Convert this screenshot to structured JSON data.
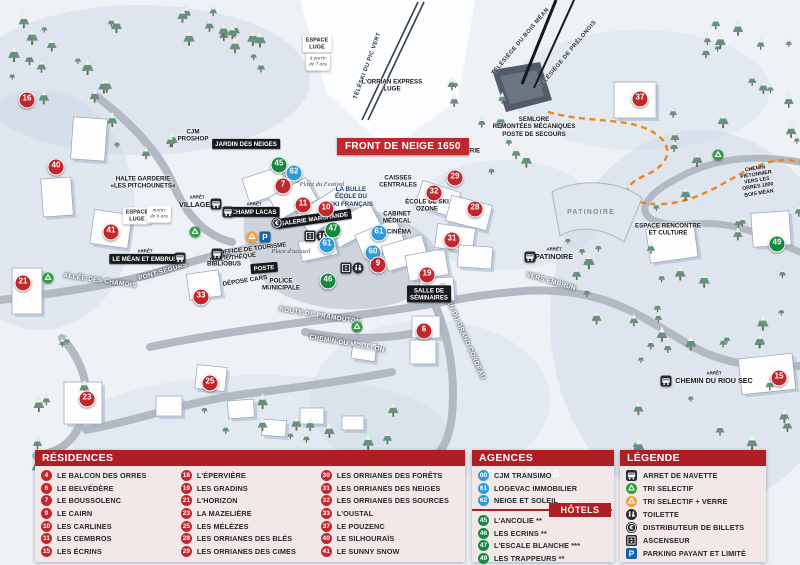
{
  "colors": {
    "residence": "#c1272d",
    "agency": "#2b9cd8",
    "hotel": "#14893f",
    "header": "#b01d23",
    "panel_bg": "#f4e7e7",
    "dash": "#f08519"
  },
  "map": {
    "front_badge": "FRONT DE NEIGE 1650",
    "arret_label": "ARRÊT",
    "markers": [
      {
        "n": "16",
        "type": "residence",
        "x": 27,
        "y": 100
      },
      {
        "n": "40",
        "type": "residence",
        "x": 56,
        "y": 167
      },
      {
        "n": "41",
        "type": "residence",
        "x": 111,
        "y": 232
      },
      {
        "n": "21",
        "type": "residence",
        "x": 23,
        "y": 283
      },
      {
        "n": "23",
        "type": "residence",
        "x": 87,
        "y": 399
      },
      {
        "n": "25",
        "type": "residence",
        "x": 210,
        "y": 383
      },
      {
        "n": "33",
        "type": "residence",
        "x": 201,
        "y": 297
      },
      {
        "n": "45",
        "type": "hotel",
        "x": 279,
        "y": 165
      },
      {
        "n": "62",
        "type": "agency",
        "x": 294,
        "y": 173
      },
      {
        "n": "7",
        "type": "residence",
        "x": 283,
        "y": 186
      },
      {
        "n": "11",
        "type": "residence",
        "x": 303,
        "y": 205
      },
      {
        "n": "10",
        "type": "residence",
        "x": 326,
        "y": 209
      },
      {
        "n": "47",
        "type": "hotel",
        "x": 333,
        "y": 230
      },
      {
        "n": "61",
        "type": "agency",
        "x": 327,
        "y": 245
      },
      {
        "n": "61",
        "type": "agency",
        "x": 379,
        "y": 233
      },
      {
        "n": "60",
        "type": "agency",
        "x": 373,
        "y": 253
      },
      {
        "n": "9",
        "type": "residence",
        "x": 378,
        "y": 265
      },
      {
        "n": "46",
        "type": "hotel",
        "x": 328,
        "y": 281
      },
      {
        "n": "19",
        "type": "residence",
        "x": 427,
        "y": 275
      },
      {
        "n": "6",
        "type": "residence",
        "x": 424,
        "y": 331
      },
      {
        "n": "32",
        "type": "residence",
        "x": 434,
        "y": 193
      },
      {
        "n": "29",
        "type": "residence",
        "x": 455,
        "y": 178
      },
      {
        "n": "28",
        "type": "residence",
        "x": 475,
        "y": 209
      },
      {
        "n": "31",
        "type": "residence",
        "x": 452,
        "y": 240
      },
      {
        "n": "37",
        "type": "residence",
        "x": 640,
        "y": 99
      },
      {
        "n": "49",
        "type": "hotel",
        "x": 777,
        "y": 244
      },
      {
        "n": "15",
        "type": "residence",
        "x": 779,
        "y": 378
      }
    ],
    "labels": [
      {
        "t": "ALLÉE DES CHAMOIS",
        "x": 100,
        "y": 281,
        "s": "road",
        "r": 8
      },
      {
        "t": "PONT SEGURS",
        "x": 163,
        "y": 272,
        "s": "road",
        "r": -16
      },
      {
        "t": "ROUTE DE PRAMOUTON",
        "x": 320,
        "y": 316,
        "s": "road",
        "r": 9
      },
      {
        "t": "CHEMIN DU MOUFLON",
        "x": 347,
        "y": 344,
        "s": "road",
        "r": 10
      },
      {
        "t": "CHEMIN DU GRAND CORDEAU",
        "x": 462,
        "y": 332,
        "s": "road",
        "r": 66
      },
      {
        "t": "VERS EMBRUN",
        "x": 551,
        "y": 282,
        "s": "road",
        "r": 16
      },
      {
        "t": "LAVERIE",
        "x": 467,
        "y": 151,
        "s": "dark",
        "r": 0
      },
      {
        "t": "CAISSES\nCENTRALES",
        "x": 398,
        "y": 182,
        "s": "dark",
        "r": 0
      },
      {
        "t": "ÉCOLE DE SKI\nOZONE",
        "x": 427,
        "y": 206,
        "s": "dark",
        "r": 0
      },
      {
        "t": "CABINET\nMÉDICAL",
        "x": 397,
        "y": 218,
        "s": "dark",
        "r": 0
      },
      {
        "t": "CINÉMA",
        "x": 399,
        "y": 232,
        "s": "dark",
        "r": 0
      },
      {
        "t": "LA BULLE\nÉCOLE DU\nSKI FRANÇAIS",
        "x": 351,
        "y": 197,
        "s": "blue",
        "r": 0
      },
      {
        "t": "HALTE GARDERIE\n«LES PITCHOUNETS»",
        "x": 143,
        "y": 183,
        "s": "dark",
        "r": 0
      },
      {
        "t": "OFFICE DE TOURISME",
        "x": 253,
        "y": 249,
        "s": "dark",
        "r": -7
      },
      {
        "t": "BIBLIOTHÈQUE",
        "x": 233,
        "y": 258,
        "s": "dark",
        "r": -7
      },
      {
        "t": "DÉPOSE CARS",
        "x": 245,
        "y": 281,
        "s": "dark",
        "r": -9
      },
      {
        "t": "POLICE\nMUNICIPALE",
        "x": 281,
        "y": 285,
        "s": "dark",
        "r": 0
      },
      {
        "t": "SEMLORE\nREMONTÉES MÉCANIQUES\nPOSTE DE SECOURS",
        "x": 534,
        "y": 127,
        "s": "dark",
        "r": 0
      },
      {
        "t": "PATINOIRE",
        "x": 591,
        "y": 213,
        "s": "gray",
        "r": 0
      },
      {
        "t": "ESPACE RENCONTRE\nET CULTURE",
        "x": 668,
        "y": 230,
        "s": "dark",
        "r": 0
      },
      {
        "t": "CJM\nPROSHOP",
        "x": 193,
        "y": 136,
        "s": "dark",
        "r": 0
      },
      {
        "t": "L'ORRIAN EXPRESS\nLUGE",
        "x": 392,
        "y": 86,
        "s": "dark",
        "r": 0
      },
      {
        "t": "TÉLÉSKI DU PIC VERT",
        "x": 368,
        "y": 66,
        "s": "lift",
        "r": -70
      },
      {
        "t": "TÉLÉSIÈGE DU BOIS MÉAN",
        "x": 521,
        "y": 42,
        "s": "lift",
        "r": -50
      },
      {
        "t": "TÉLÉSIÈGE DE PRÉLONGIS",
        "x": 568,
        "y": 55,
        "s": "lift",
        "r": -50
      },
      {
        "t": "CHEMIN PIÉTONNIER\nVERS LES ORRES 1800\nBOIS MÉAN",
        "x": 757,
        "y": 181,
        "s": "tiny",
        "r": -9
      },
      {
        "t": "VILLAGES",
        "x": 197,
        "y": 205,
        "s": "place",
        "r": 0,
        "a": true
      },
      {
        "t": "LE MÉAN ET EMBRUN",
        "x": 145,
        "y": 259,
        "s": "bar",
        "r": 0,
        "a": true
      },
      {
        "t": "PATINOIRE",
        "x": 554,
        "y": 257,
        "s": "place",
        "r": 0,
        "a": true
      },
      {
        "t": "CHEMIN DU RIOU SEC",
        "x": 714,
        "y": 381,
        "s": "place",
        "r": 0,
        "a": true
      },
      {
        "t": "BIBLIOBUS",
        "x": 224,
        "y": 264,
        "s": "dark",
        "r": 0,
        "a": true
      },
      {
        "t": "CHAMP LACAS",
        "x": 254,
        "y": 212,
        "s": "bar",
        "r": 0,
        "a": true
      },
      {
        "t": "GALERIE MARCHANDE",
        "x": 314,
        "y": 219,
        "s": "bar",
        "r": -8
      },
      {
        "t": "POSTE",
        "x": 264,
        "y": 268,
        "s": "bar",
        "r": -5
      },
      {
        "t": "SALLE DE\nSÉMINAIRES",
        "x": 429,
        "y": 294,
        "s": "bar",
        "r": 0
      },
      {
        "t": "JARDIN DES NEIGES",
        "x": 246,
        "y": 144,
        "s": "bar",
        "r": 0
      },
      {
        "t": "Place du Festival",
        "x": 322,
        "y": 185,
        "s": "italic",
        "r": 0
      },
      {
        "t": "Place d'accueil",
        "x": 291,
        "y": 252,
        "s": "italic",
        "r": 0
      },
      {
        "t": "ESPACE\nLUGE",
        "x": 137,
        "y": 216,
        "s": "box",
        "r": 0
      },
      {
        "t": "moins\nde 6 ans",
        "x": 159,
        "y": 214,
        "s": "boxi",
        "r": 0
      },
      {
        "t": "ESPACE\nLUGE",
        "x": 317,
        "y": 44,
        "s": "box",
        "r": 0
      },
      {
        "t": "à partir\nde 7 ans",
        "x": 318,
        "y": 62,
        "s": "boxi",
        "r": 0
      }
    ],
    "icons": [
      {
        "sym": "bus",
        "x": 216,
        "y": 204
      },
      {
        "sym": "bus",
        "x": 228,
        "y": 212
      },
      {
        "sym": "bus",
        "x": 180,
        "y": 258
      },
      {
        "sym": "bus",
        "x": 217,
        "y": 254
      },
      {
        "sym": "bus",
        "x": 530,
        "y": 257
      },
      {
        "sym": "bus",
        "x": 666,
        "y": 381
      },
      {
        "sym": "recycle",
        "x": 48,
        "y": 278
      },
      {
        "sym": "recycle",
        "x": 195,
        "y": 232
      },
      {
        "sym": "recycle",
        "x": 357,
        "y": 327
      },
      {
        "sym": "recycle",
        "x": 718,
        "y": 155
      },
      {
        "sym": "recycle2",
        "x": 252,
        "y": 237
      },
      {
        "sym": "parking",
        "x": 265,
        "y": 237
      },
      {
        "sym": "euro",
        "x": 277,
        "y": 223
      },
      {
        "sym": "wc",
        "x": 322,
        "y": 236
      },
      {
        "sym": "wc",
        "x": 358,
        "y": 268
      },
      {
        "sym": "lift",
        "x": 310,
        "y": 236
      },
      {
        "sym": "lift",
        "x": 346,
        "y": 268
      }
    ]
  },
  "panels": {
    "residences": {
      "title": "RÉSIDENCES",
      "items": [
        {
          "n": "4",
          "label": "LE BALCON DES ORRES"
        },
        {
          "n": "6",
          "label": "LE BELVÉDÈRE"
        },
        {
          "n": "7",
          "label": "LE BOUSSOLENC"
        },
        {
          "n": "9",
          "label": "LE CAIRN"
        },
        {
          "n": "10",
          "label": "LES CARLINES"
        },
        {
          "n": "11",
          "label": "LES CEMBROS"
        },
        {
          "n": "15",
          "label": "LES ÉCRINS"
        },
        {
          "n": "16",
          "label": "L'ÉPERVIÈRE"
        },
        {
          "n": "19",
          "label": "LES GRADINS"
        },
        {
          "n": "21",
          "label": "L'HORIZON"
        },
        {
          "n": "23",
          "label": "LA MAZELIÈRE"
        },
        {
          "n": "25",
          "label": "LES MÉLÈZES"
        },
        {
          "n": "28",
          "label": "LES ORRIANES DES BLÉS"
        },
        {
          "n": "29",
          "label": "LES ORRIANES DES CIMES"
        },
        {
          "n": "30",
          "label": "LES ORRIANES DES FORÊTS"
        },
        {
          "n": "31",
          "label": "LES ORRIANES DES NEIGES"
        },
        {
          "n": "32",
          "label": "LES ORRIANES DES SOURCES"
        },
        {
          "n": "33",
          "label": "L'OUSTAL"
        },
        {
          "n": "37",
          "label": "LE POUZENC"
        },
        {
          "n": "40",
          "label": "LE SILHOURAÏS"
        },
        {
          "n": "41",
          "label": "LE SUNNY SNOW"
        }
      ]
    },
    "agencies": {
      "title": "AGENCES IMMOBILIÈRES",
      "items": [
        {
          "n": "60",
          "label": "CJM TRANSIMO"
        },
        {
          "n": "61",
          "label": "LOGEVAC IMMOBILIER"
        },
        {
          "n": "62",
          "label": "NEIGE ET SOLEIL"
        }
      ]
    },
    "hotels": {
      "title": "HÔTELS",
      "items": [
        {
          "n": "45",
          "label": "L'ANCOLIE **"
        },
        {
          "n": "46",
          "label": "LES ECRINS **"
        },
        {
          "n": "47",
          "label": "L'ESCALE BLANCHE ***"
        },
        {
          "n": "49",
          "label": "LES TRAPPEURS **"
        }
      ]
    },
    "legend": {
      "title": "LÉGENDE",
      "items": [
        {
          "icon": "bus",
          "label": "ARRET DE NAVETTE"
        },
        {
          "icon": "recycle",
          "label": "TRI SELECTIF"
        },
        {
          "icon": "recycle2",
          "label": "TRI SELECTIF + VERRE"
        },
        {
          "icon": "wc",
          "label": "TOILETTE"
        },
        {
          "icon": "euro",
          "label": "DISTRIBUTEUR DE BILLETS"
        },
        {
          "icon": "lift",
          "label": "ASCENSEUR"
        },
        {
          "icon": "parking",
          "label": "PARKING PAYANT ET LIMITÉ"
        }
      ]
    }
  }
}
